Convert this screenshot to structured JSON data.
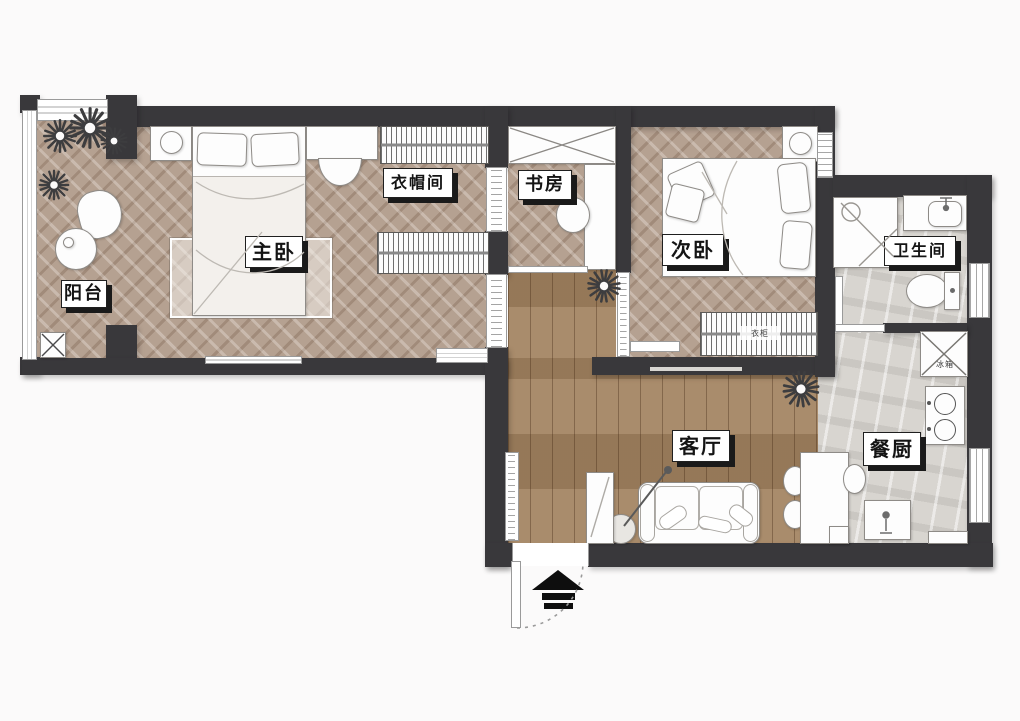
{
  "floorplan": {
    "type": "apartment-floor-plan",
    "rooms": [
      {
        "id": "balcony",
        "label": "阳台"
      },
      {
        "id": "master-bedroom",
        "label": "主卧"
      },
      {
        "id": "cloakroom",
        "label": "衣帽间"
      },
      {
        "id": "study",
        "label": "书房"
      },
      {
        "id": "second-bedroom",
        "label": "次卧"
      },
      {
        "id": "bathroom",
        "label": "卫生间"
      },
      {
        "id": "living-room",
        "label": "客厅"
      },
      {
        "id": "dining-kitchen",
        "label": "餐厨"
      }
    ],
    "furniture": {
      "wardrobe_label": "衣柜",
      "fridge_label": "冰箱"
    },
    "icons": [
      "plant-icon",
      "entry-arrow-icon",
      "door-swing-arc-icon",
      "shower-icon",
      "toilet-icon",
      "stove-icon",
      "sink-icon"
    ],
    "colors": {
      "wall": "#39383b",
      "herringbone_floor": "#b5a191",
      "plank_floor": "#a2825f",
      "stone_floor": "#d8d5d0",
      "label_bg": "#ffffff",
      "label_text": "#141414",
      "label_shadow": "#1a1a1a",
      "background": "#fafafa"
    }
  }
}
